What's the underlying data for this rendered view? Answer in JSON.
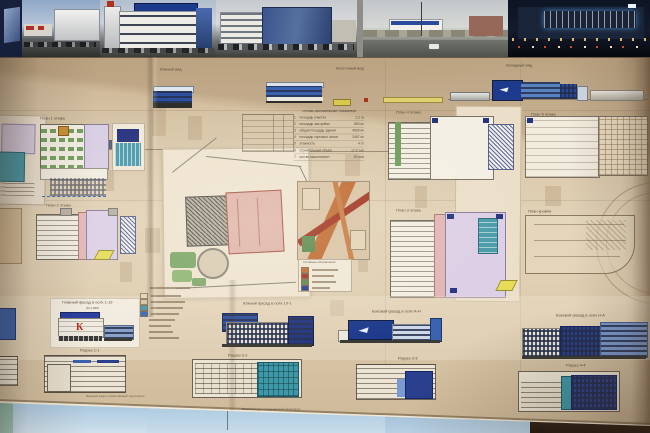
{
  "views": {
    "south_label": "Южный вид",
    "east_label": "Восточный вид",
    "west_label": "Западный вид"
  },
  "plans": {
    "p1_label": "План 1 этажа",
    "p2_label": "План 2 этажа",
    "p3_label": "План 3 этажа",
    "p4_label": "План 4 этажа",
    "p5_label": "План 5 этажа",
    "roof_label": "План кровли"
  },
  "tep": {
    "title": "Технико-экономические показатели",
    "rows": [
      {
        "n": "1",
        "name": "площадь участка",
        "value": "1,2 га"
      },
      {
        "n": "2",
        "name": "площадь застройки",
        "value": "650 м²"
      },
      {
        "n": "3",
        "name": "общая площадь здания",
        "value": "4900 м²"
      },
      {
        "n": "4",
        "name": "площадь торговых залов",
        "value": "2467 м²"
      },
      {
        "n": "5",
        "name": "этажность",
        "value": "4 эт"
      },
      {
        "n": "6",
        "name": "строительный объём",
        "value": "17,9 т.м³"
      },
      {
        "n": "7",
        "name": "кол-во машиномест",
        "value": "90 м/м"
      }
    ]
  },
  "elevations": {
    "e1_label": "Главный фасад в осях 1-19",
    "e1_scale": "(М 1:200)",
    "e2_label": "Южный фасад в осях 19-1",
    "e3_label": "Боковой фасад в осях А-Н",
    "e4_label": "Боковой фасад в осях Н-А",
    "logo_letter": "К"
  },
  "sections": {
    "s1_label": "Разрез 1-1",
    "s2_label": "Разрез 2-2",
    "s3_label": "Разрез 3-3",
    "s4_label": "Разрез 4-4"
  },
  "captions": {
    "c1": "Видовой кадр с прилегающей территории",
    "c2": "Видовой кадр с прилегающей территории",
    "c3": "Видовой кадр с прилегающей территории"
  },
  "site_map": {
    "legend_title": "Условные обозначения"
  },
  "colors": {
    "facade_blue": "#2b3f9e",
    "glass_blue": "#5a82c8",
    "teal": "#3f9aaa",
    "lavender": "#dccfe6",
    "pink": "#e2b6b2",
    "green": "#6f9e5a",
    "yellow": "#e6dc5a",
    "road_orange": "#c06a30",
    "road_red": "#a03420",
    "board_beige": "#d9c6a8",
    "logo_red": "#b02a20"
  }
}
